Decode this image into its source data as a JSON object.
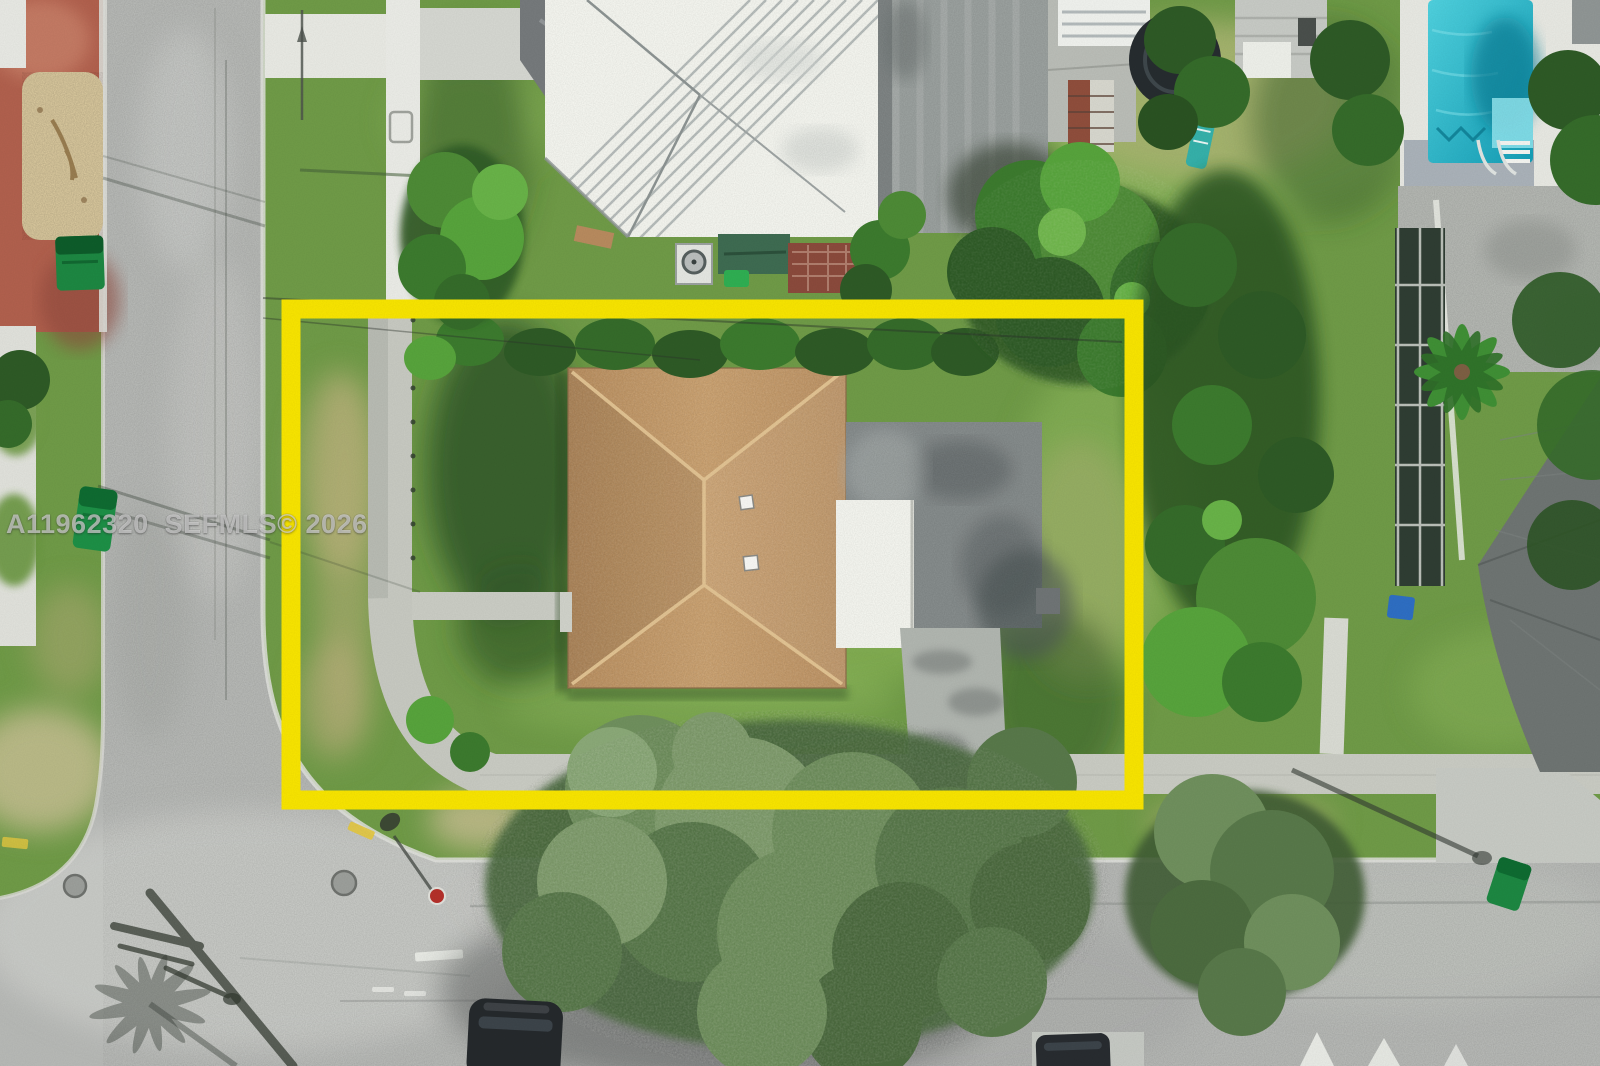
{
  "watermark": {
    "text": "A11962320  SEFMLS© 2026"
  },
  "boundary": {
    "label": "highlighted-property-lot",
    "color": "#F6E300"
  },
  "palette": {
    "grass_base": "#6f9a47",
    "grass_light": "#9ec768",
    "grass_dark": "#2c5124",
    "grass_dry": "#b9ae7c",
    "canopy_dark": "#2e5526",
    "canopy_mid": "#4d7f38",
    "canopy_light": "#76a455",
    "canopy_sage": "#7f9c6c",
    "road": "#b6b8b5",
    "road_light": "#cccdc9",
    "concrete": "#e2e3de",
    "sidewalk": "#c8cac2",
    "brick_red": "#b0604d",
    "gravel": "#d7c69c",
    "roof_tan": "#c69c6d",
    "roof_white": "#f3f4ee",
    "roof_flat_gray": "#878d8d",
    "roof_streak_gray": "#9ba19f",
    "pool_teal": "#28b9cd",
    "bin_green": "#1d8742",
    "bin_blue": "#2e6ec2",
    "car_dark": "#25292c",
    "stop_sign_red": "#b3302a",
    "shadow": "#343b36"
  }
}
